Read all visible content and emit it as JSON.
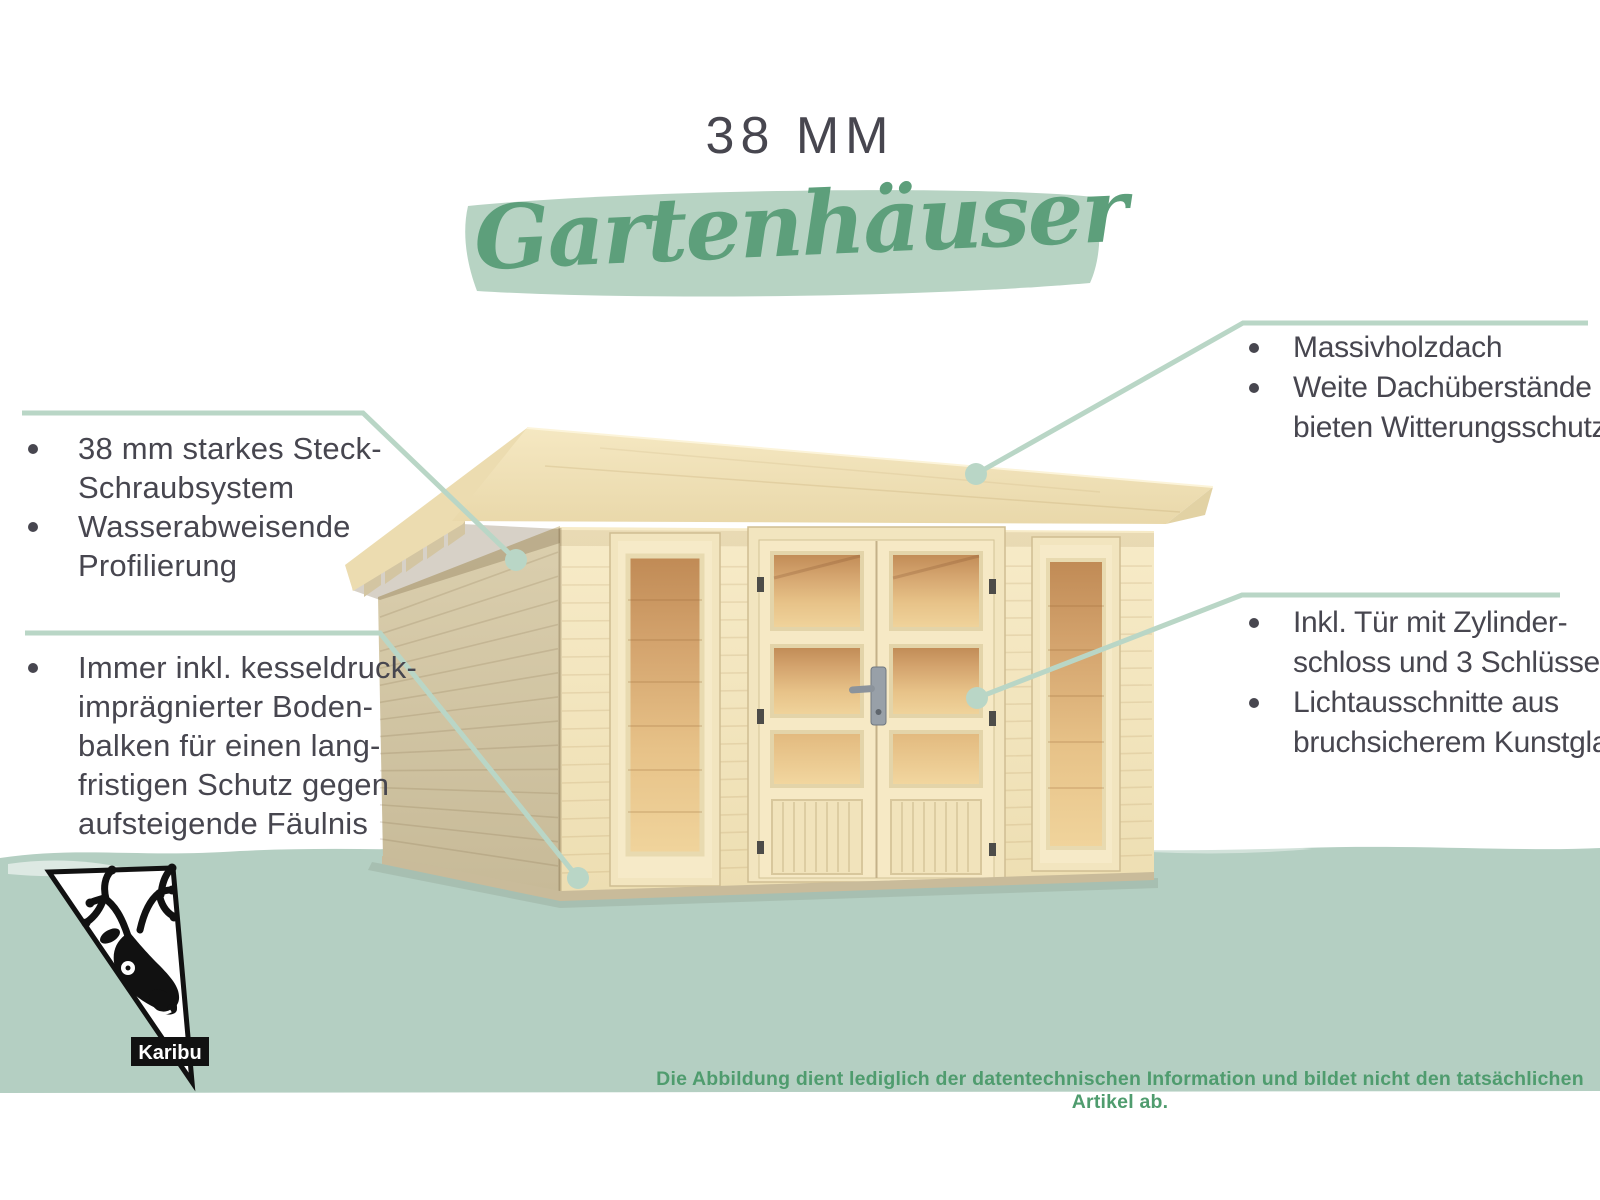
{
  "title": "38 MM",
  "subtitle": "Gartenhäuser",
  "callouts": {
    "left_top": {
      "lines": [
        {
          "bullet": true,
          "text": "38 mm starkes Steck-"
        },
        {
          "bullet": false,
          "text": "Schraubsystem"
        },
        {
          "bullet": true,
          "text": "Wasserabweisende"
        },
        {
          "bullet": false,
          "text": "Profilierung"
        }
      ]
    },
    "left_bottom": {
      "lines": [
        {
          "bullet": true,
          "text": "Immer inkl. kesseldruck-"
        },
        {
          "bullet": false,
          "text": "imprägnierter Boden-"
        },
        {
          "bullet": false,
          "text": "balken für einen lang-"
        },
        {
          "bullet": false,
          "text": "fristigen Schutz gegen"
        },
        {
          "bullet": false,
          "text": "aufsteigende Fäulnis"
        }
      ]
    },
    "right_top": {
      "lines": [
        {
          "bullet": true,
          "text": "Massivholzdach"
        },
        {
          "bullet": true,
          "text": "Weite Dachüberstände"
        },
        {
          "bullet": false,
          "text": "bieten Witterungsschutz"
        }
      ]
    },
    "right_middle": {
      "lines": [
        {
          "bullet": true,
          "text": "Inkl. Tür mit Zylinder-"
        },
        {
          "bullet": false,
          "text": "schloss und 3 Schlüsseln"
        },
        {
          "bullet": true,
          "text": "Lichtausschnitte aus"
        },
        {
          "bullet": false,
          "text": "bruchsicherem Kunstglas"
        }
      ]
    }
  },
  "footer": {
    "disclaimer": "Die Abbildung dient lediglich der datentechnischen Information und bildet nicht den tatsächlichen Artikel ab."
  },
  "logo": {
    "brand": "Karibu"
  },
  "colors": {
    "text_dark": "#47464f",
    "script_green": "#5d9f7b",
    "brush_band": "#b7d3c3",
    "ground_band": "#b4cfc2",
    "callout_line": "#b9d6c6",
    "disclaimer_green": "#4f9c6e"
  }
}
